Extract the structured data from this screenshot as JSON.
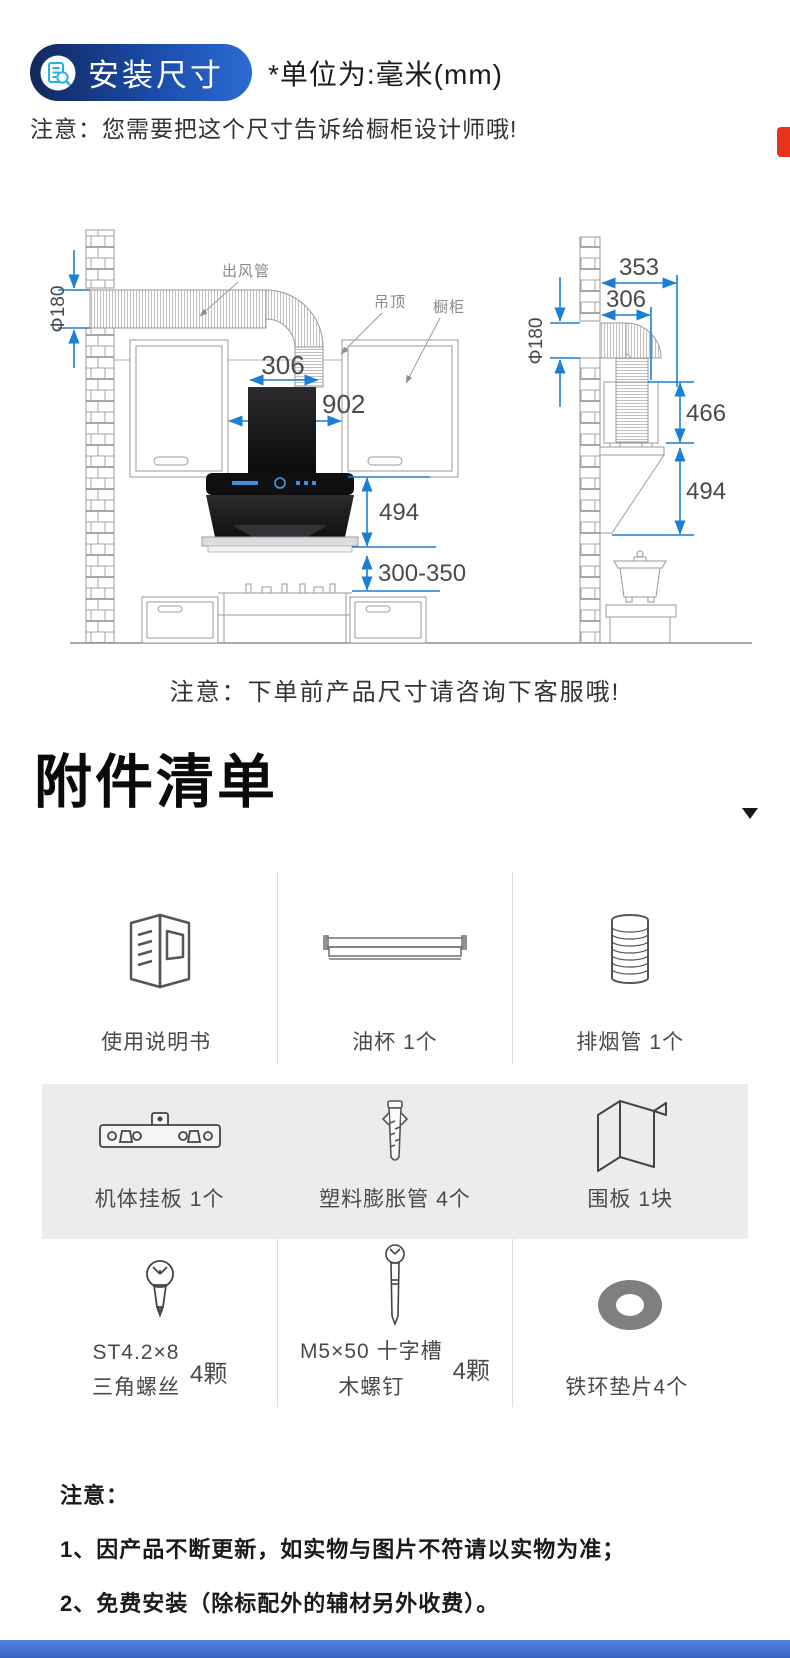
{
  "header": {
    "badge_label": "安装尺寸",
    "badge_icon": "document-magnifier-icon",
    "unit_note": "*单位为:毫米(mm)",
    "note": "注意：您需要把这个尺寸告诉给橱柜设计师哦!"
  },
  "diagram": {
    "front_view": {
      "duct_label": "出风管",
      "ceiling_label": "吊顶",
      "cabinet_label": "橱柜",
      "duct_diameter": "Φ180",
      "duct_width": "306",
      "opening_width": "902",
      "hood_height": "494",
      "hood_to_cooktop": "300-350"
    },
    "side_view": {
      "total_depth": "353",
      "duct_depth": "306",
      "duct_diameter": "Φ180",
      "upper_height": "466",
      "lower_height": "494"
    },
    "note": "注意：下单前产品尺寸请咨询下客服哦!"
  },
  "accessories": {
    "title": "附件清单",
    "collapse_icon": "chevron-down-icon",
    "items": [
      {
        "icon": "manual-icon",
        "line1": "使用说明书",
        "line2": "",
        "qty": ""
      },
      {
        "icon": "oil-cup-icon",
        "line1": "油杯",
        "line2": "",
        "qty": "1个"
      },
      {
        "icon": "exhaust-pipe-icon",
        "line1": "排烟管",
        "line2": "",
        "qty": "1个"
      },
      {
        "icon": "mounting-plate-icon",
        "line1": "机体挂板",
        "line2": "",
        "qty": "1个"
      },
      {
        "icon": "expansion-anchor-icon",
        "line1": "塑料膨胀管",
        "line2": "",
        "qty": "4个"
      },
      {
        "icon": "enclosure-panel-icon",
        "line1": "围板",
        "line2": "",
        "qty": "1块"
      },
      {
        "icon": "short-screw-icon",
        "line1": "ST4.2×8",
        "line2": "三角螺丝",
        "qty": "4颗"
      },
      {
        "icon": "long-screw-icon",
        "line1": "M5×50 十字槽",
        "line2": "木螺钉",
        "qty": "4颗"
      },
      {
        "icon": "washer-icon",
        "line1": "铁环垫片4个",
        "line2": "",
        "qty": ""
      }
    ]
  },
  "footer_notes": {
    "title": "注意：",
    "items": [
      "1、因产品不断更新，如实物与图片不符请以实物为准；",
      "2、免费安装（除标配外的辅材另外收费）。"
    ]
  },
  "colors": {
    "badge_gradient_start": "#12285d",
    "badge_gradient_end": "#2d6cd3",
    "dimension_blue": "#1b7fd4",
    "drawing_gray": "#9a9a9a",
    "gray_band": "#ececec",
    "red_tab": "#e8331c",
    "bottom_bar_blue": "#3a63c6"
  }
}
